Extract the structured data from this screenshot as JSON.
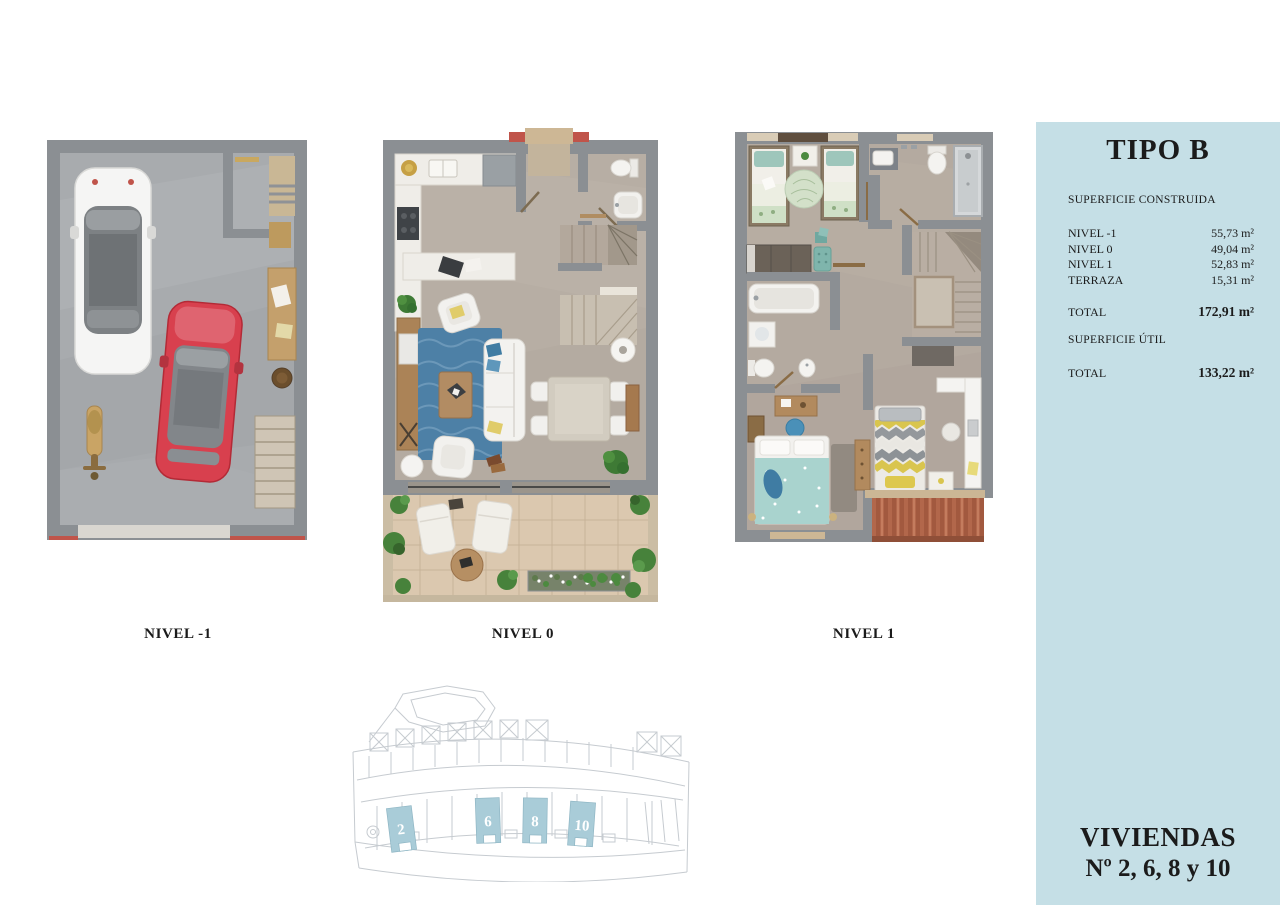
{
  "sidebar": {
    "title": "TIPO B",
    "built": {
      "heading": "SUPERFICIE CONSTRUIDA",
      "rows": [
        {
          "label": "NIVEL -1",
          "value": "55,73 m²"
        },
        {
          "label": "NIVEL 0",
          "value": "49,04 m²"
        },
        {
          "label": "NIVEL 1",
          "value": "52,83 m²"
        },
        {
          "label": "TERRAZA",
          "value": "15,31 m²"
        }
      ],
      "total_label": "TOTAL",
      "total_value": "172,91 m²"
    },
    "useful": {
      "heading": "SUPERFICIE ÚTIL",
      "total_label": "TOTAL",
      "total_value": "133,22 m²"
    },
    "footer": {
      "line1": "VIVIENDAS",
      "line2": "Nº 2, 6, 8 y 10"
    }
  },
  "plans": [
    {
      "label": "NIVEL -1"
    },
    {
      "label": "NIVEL 0"
    },
    {
      "label": "NIVEL 1"
    }
  ],
  "siteplan": {
    "highlighted_units": [
      {
        "number": "2"
      },
      {
        "number": "6"
      },
      {
        "number": "8"
      },
      {
        "number": "10"
      }
    ]
  },
  "colors": {
    "sidebar_bg": "#c5dfe6",
    "highlight_unit": "#a9ccd8",
    "text": "#1b1b1b",
    "wall": "#8b8f93",
    "garage_floor": "#a8abae",
    "floor": "#b7aea4",
    "terrace": "#dbc8af",
    "rug": "#4d80a6",
    "roof": "#b2674b",
    "accent_red": "#c0544a",
    "siteplan_line": "#c6cbd0"
  }
}
